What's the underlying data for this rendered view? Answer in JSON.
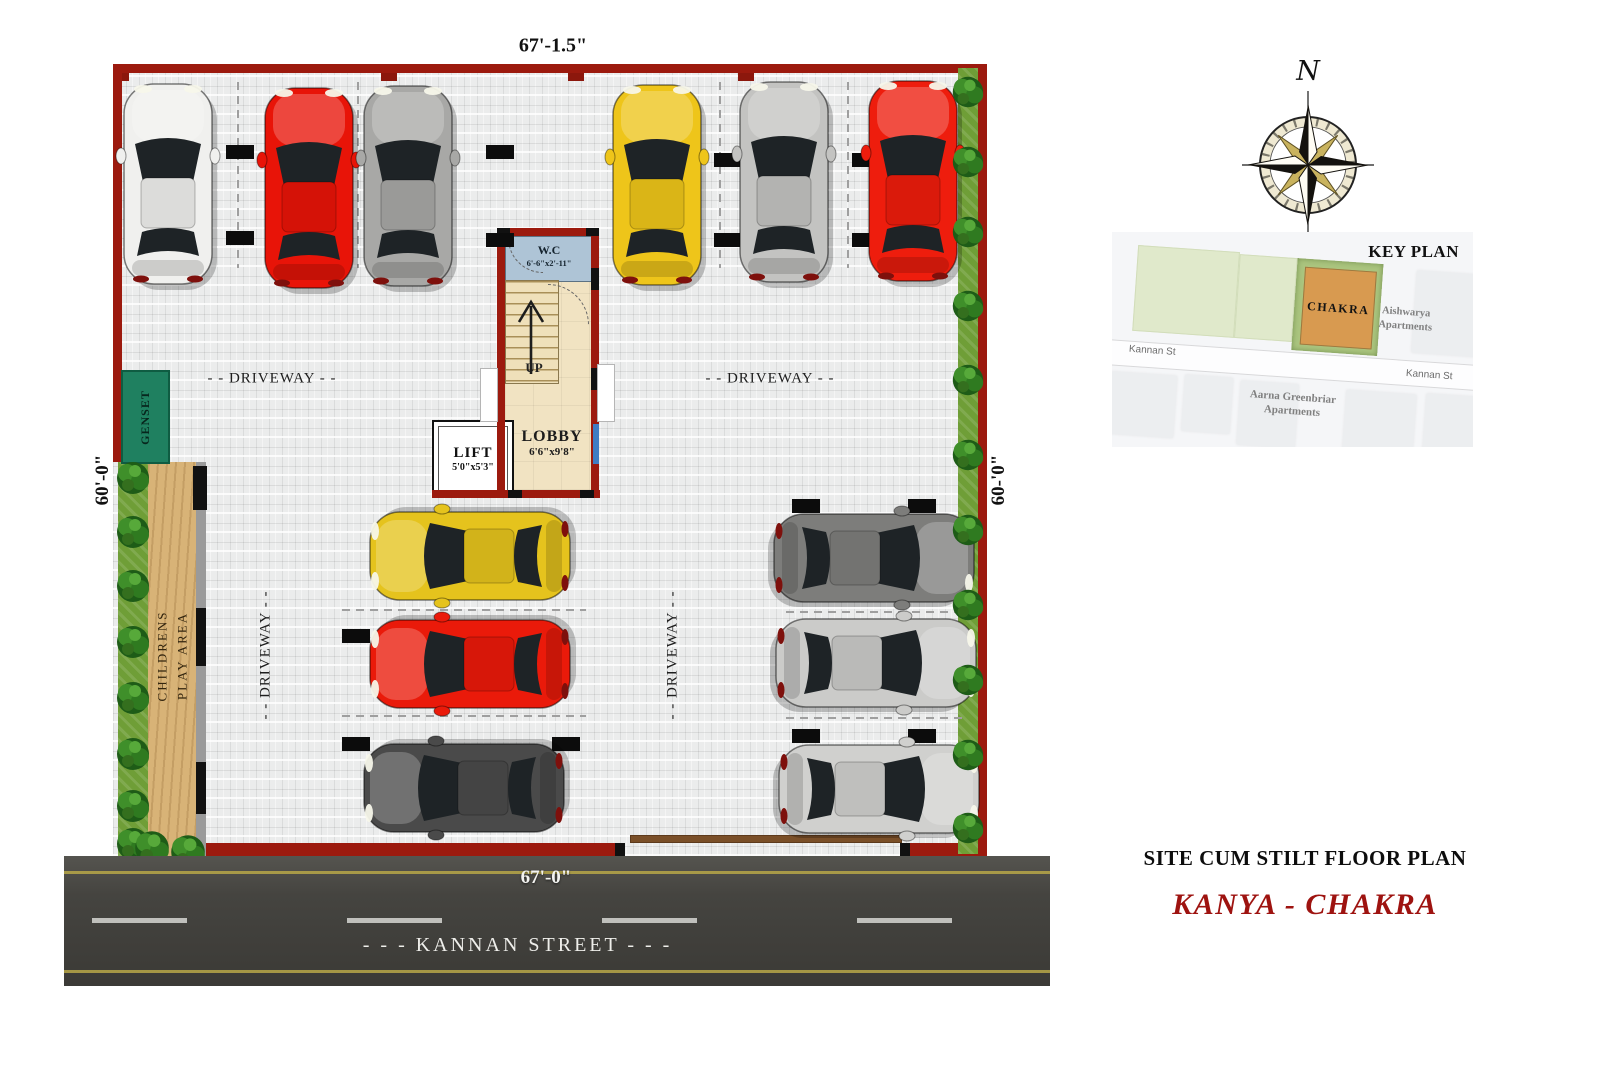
{
  "sheet": {
    "title": "SITE CUM STILT FLOOR PLAN",
    "project_name": "KANYA - CHAKRA"
  },
  "compass": {
    "north": "N"
  },
  "key_plan": {
    "title": "KEY PLAN",
    "site": "CHAKRA",
    "street_left": "Kannan St",
    "street_right": "Kannan St",
    "neighbor_east_line1": "Aishwarya",
    "neighbor_east_line2": "Apartments",
    "neighbor_south_line1": "Aarna  Greenbriar",
    "neighbor_south_line2": "Apartments"
  },
  "dimensions": {
    "top": "67'-1.5\"",
    "left": "60'-0\"",
    "right": "60-'0\"",
    "bottom": "67'-0\""
  },
  "street_name": "- - - KANNAN STREET - - -",
  "plan_labels": {
    "driveway": "- - DRIVEWAY - -",
    "genset": "GENSET",
    "play_area_line1": "CHILDRENS",
    "play_area_line2": "PLAY AREA",
    "up": "UP"
  },
  "rooms": {
    "wc_name": "W.C",
    "wc_size": "6'-6\"x2'-11\"",
    "lift_name": "LIFT",
    "lift_size": "5'0\"x5'3\"",
    "lobby_name": "LOBBY",
    "lobby_size": "6'6\"x9'8\""
  },
  "colors": {
    "boundary_wall": "#9c1a0e",
    "project_accent": "#9e1310",
    "key_plan_site": "#d89a50",
    "genset_green": "#1f8060"
  },
  "cars": [
    {
      "id": "car-white-top",
      "color": "#f0f0ee",
      "x": 168,
      "y": 184,
      "deg": 0
    },
    {
      "id": "car-red-top",
      "color": "#e81408",
      "x": 309,
      "y": 188,
      "deg": 0
    },
    {
      "id": "car-grey-top",
      "color": "#a8a8a6",
      "x": 408,
      "y": 186,
      "deg": 0
    },
    {
      "id": "car-yellow-top",
      "color": "#eec51a",
      "x": 657,
      "y": 185,
      "deg": 0
    },
    {
      "id": "car-silver-top",
      "color": "#c3c3c1",
      "x": 784,
      "y": 182,
      "deg": 0
    },
    {
      "id": "car-red2-top",
      "color": "#ee1d0d",
      "x": 913,
      "y": 181,
      "deg": 0
    },
    {
      "id": "car-yellow-mid",
      "color": "#e5c31d",
      "x": 470,
      "y": 556,
      "deg": -90
    },
    {
      "id": "car-red-mid",
      "color": "#ea1a0a",
      "x": 470,
      "y": 664,
      "deg": -90
    },
    {
      "id": "car-black-mid",
      "color": "#4a4a4a",
      "x": 464,
      "y": 788,
      "deg": -90
    },
    {
      "id": "car-grey-right",
      "color": "#7d7d7b",
      "x": 874,
      "y": 558,
      "deg": 90
    },
    {
      "id": "car-silver-right1",
      "color": "#cbcbc9",
      "x": 876,
      "y": 663,
      "deg": 90
    },
    {
      "id": "car-silver-right2",
      "color": "#d0d0ce",
      "x": 879,
      "y": 789,
      "deg": 90
    }
  ]
}
